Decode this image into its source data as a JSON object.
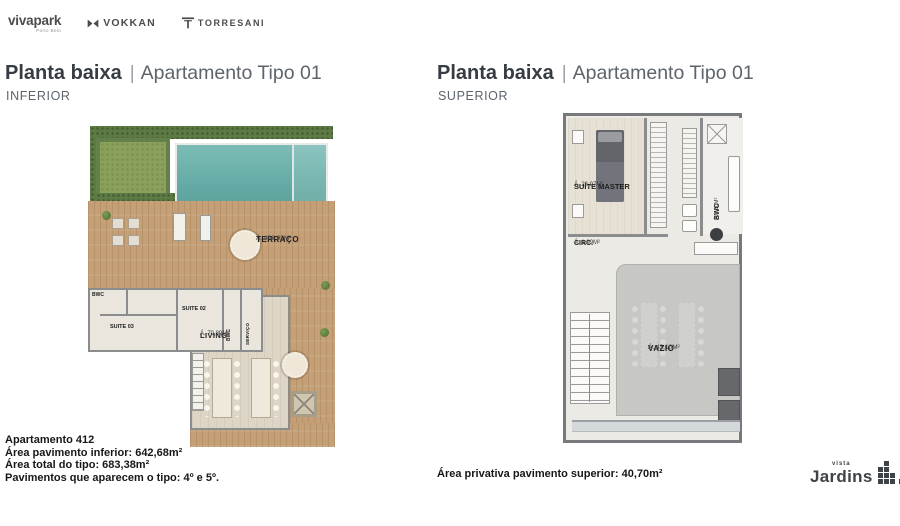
{
  "brands": {
    "vivapark_main": "vivapark",
    "vivapark_sub": "Porto Belo",
    "vokkan": "VOKKAN",
    "torresani": "TORRESANI"
  },
  "left_section": {
    "title_strong": "Planta baixa",
    "title_sep": "|",
    "title_light": "Apartamento Tipo 01",
    "subtitle": "INFERIOR",
    "plan": {
      "terraco_name": "TERRAÇO",
      "terraco_area": "Á. 493,93M²",
      "bwc1_name": "BWC",
      "suite03_name": "SUITE 03",
      "suite02_name": "SUITE 02",
      "bwc2_name": "BWC",
      "servico_name": "SERVIÇO",
      "living_name": "LIVING",
      "living_area": "Á. 70,89M²"
    }
  },
  "right_section": {
    "title_strong": "Planta baixa",
    "title_sep": "|",
    "title_light": "Apartamento Tipo 01",
    "subtitle": "SUPERIOR",
    "plan": {
      "suite_master_name": "SUÍTE MASTER",
      "suite_master_area": "Á. 26,97M²",
      "bwc_name": "BWC",
      "bwc_area": "Á.5,30M²",
      "circ_name": "CIRC.",
      "circ_area": "Á. 1,99M²",
      "vazio_name": "VAZIO",
      "vazio_area": "Á. 43,10M²"
    }
  },
  "footer_left": {
    "line1": "Apartamento 412",
    "line2": "Área pavimento inferior: 642,68m²",
    "line3": "Área total do tipo: 683,38m²",
    "line4": "Pavimentos que aparecem o tipo: 4º e 5º."
  },
  "footer_right": {
    "area_line": "Área privativa pavimento superior: 40,70m²",
    "logo_small": "vista",
    "logo_big": "Jardins"
  },
  "colors": {
    "title_dark": "#363c43",
    "title_light": "#5d646c",
    "deck_wood": "#c5a077",
    "pool": "#6fb2ae",
    "lawn": "#8ba05a",
    "hedge": "#5d7a45",
    "vazio_gray": "#c7c7c4",
    "brand_gray": "#4a4c4e"
  }
}
